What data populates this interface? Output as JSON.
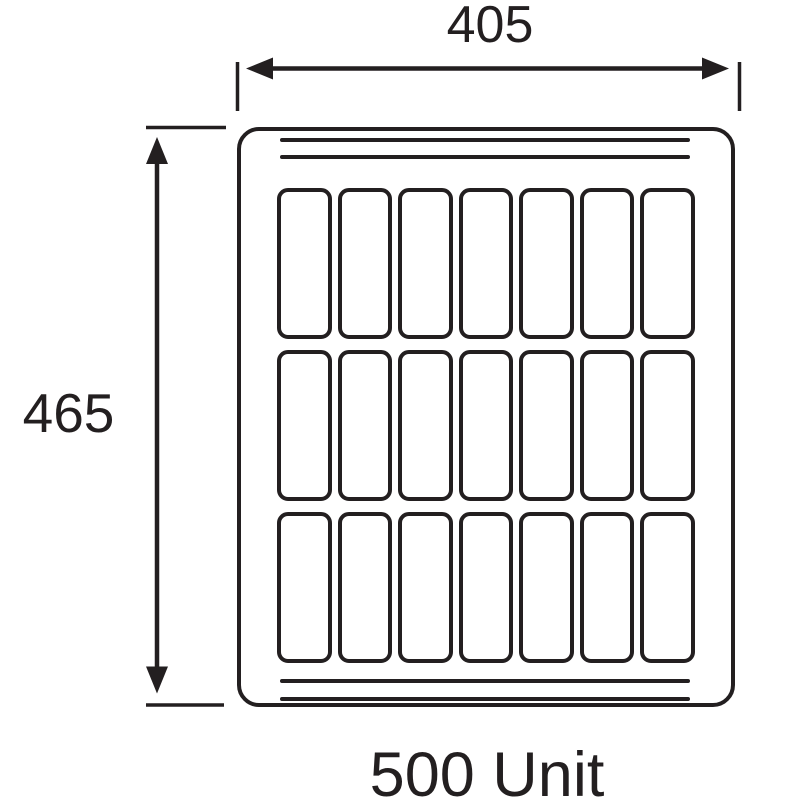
{
  "title": "500 Unit",
  "dimensions": {
    "width_label": "405",
    "height_label": "465"
  },
  "panel": {
    "grid_rows": 3,
    "grid_columns": 7,
    "cell_count": 21,
    "top_bar_lines": 2,
    "bottom_bar_lines": 2
  },
  "colors": {
    "ink": "#231f20",
    "background": "#ffffff"
  }
}
